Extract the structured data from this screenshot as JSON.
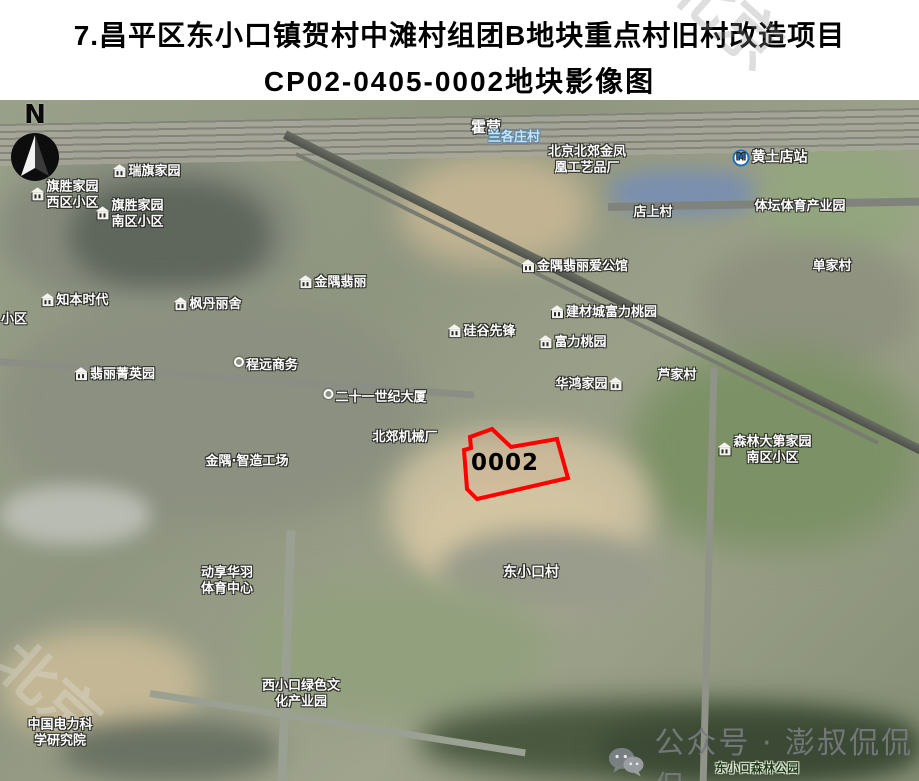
{
  "title": {
    "line1": "7.昌平区东小口镇贺村中滩村组团B地块重点村旧村改造项目",
    "line2": "CP02-0405-0002地块影像图"
  },
  "faint_watermark": "北京",
  "map": {
    "compass_letter": "N",
    "parcel": {
      "id": "0002",
      "outline_color": "#ff0000",
      "points": "492,329 511,347 557,339 568,378 477,399 467,389 464,350 471,348 470,337",
      "label_x": 505,
      "label_y": 363
    },
    "wechat_watermark": "公众号 · 澎叔侃侃侃",
    "labels": [
      {
        "text": "霍营",
        "x": 486,
        "y": 27,
        "style": "white",
        "size": 15
      },
      {
        "text": "黄土店站",
        "x": 770,
        "y": 58,
        "style": "white",
        "size": 14,
        "icon": "metro"
      },
      {
        "text": "瑞旗家园",
        "x": 147,
        "y": 72,
        "style": "white",
        "icon": "building"
      },
      {
        "text": "旗胜家园",
        "text2": "西区小区",
        "x": 65,
        "y": 95,
        "style": "white",
        "icon": "building"
      },
      {
        "text": "旗胜家园",
        "text2": "南区小区",
        "x": 130,
        "y": 114,
        "style": "white",
        "icon": "building"
      },
      {
        "text": "兰各庄村",
        "x": 514,
        "y": 38,
        "style": "blue"
      },
      {
        "text": "北京北郊金凤",
        "text2": "凰工艺品厂",
        "x": 587,
        "y": 60,
        "style": "white"
      },
      {
        "text": "店上村",
        "x": 653,
        "y": 113,
        "style": "white"
      },
      {
        "text": "体坛体育产业园",
        "x": 800,
        "y": 107,
        "style": "white"
      },
      {
        "text": "单家村",
        "x": 832,
        "y": 167,
        "style": "white"
      },
      {
        "text": "知本时代",
        "x": 75,
        "y": 201,
        "style": "white",
        "icon": "building"
      },
      {
        "text": "枫丹丽舍",
        "x": 208,
        "y": 205,
        "style": "white",
        "icon": "building"
      },
      {
        "text": "小区",
        "x": 14,
        "y": 220,
        "style": "white"
      },
      {
        "text": "翡丽菁英园",
        "x": 115,
        "y": 275,
        "style": "white",
        "icon": "building"
      },
      {
        "text": "程远商务",
        "x": 266,
        "y": 266,
        "style": "white",
        "icon": "dot"
      },
      {
        "text": "金隅翡丽",
        "x": 333,
        "y": 183,
        "style": "white",
        "icon": "building"
      },
      {
        "text": "金隅翡丽爱公馆",
        "x": 575,
        "y": 167,
        "style": "white",
        "icon": "building"
      },
      {
        "text": "硅谷先锋",
        "x": 482,
        "y": 232,
        "style": "white",
        "icon": "building"
      },
      {
        "text": "建材城富力桃园",
        "x": 604,
        "y": 213,
        "style": "white",
        "icon": "building"
      },
      {
        "text": "富力桃园",
        "x": 573,
        "y": 243,
        "style": "white",
        "icon": "building"
      },
      {
        "text": "华鸿家园",
        "x": 589,
        "y": 285,
        "style": "white",
        "icon": "building",
        "icon_side": "right"
      },
      {
        "text": "芦家村",
        "x": 677,
        "y": 276,
        "style": "white"
      },
      {
        "text": "二十一世纪大厦",
        "x": 375,
        "y": 298,
        "style": "white",
        "icon": "dot"
      },
      {
        "text": "北郊机械厂",
        "x": 405,
        "y": 338,
        "style": "white"
      },
      {
        "text": "金隅·智造工场",
        "x": 247,
        "y": 362,
        "style": "white"
      },
      {
        "text": "森林大第家园",
        "text2": "南区小区",
        "x": 765,
        "y": 350,
        "style": "white",
        "icon": "building"
      },
      {
        "text": "东小口村",
        "x": 531,
        "y": 473,
        "style": "white",
        "size": 14
      },
      {
        "text": "动享华羽",
        "text2": "体育中心",
        "x": 227,
        "y": 481,
        "style": "white"
      },
      {
        "text": "西小口绿色文",
        "text2": "化产业园",
        "x": 301,
        "y": 594,
        "style": "white"
      },
      {
        "text": "中国电力科",
        "text2": "学研究院",
        "x": 60,
        "y": 633,
        "style": "white"
      },
      {
        "text": "东小口森林公园",
        "x": 757,
        "y": 668,
        "style": "dark",
        "size": 12
      }
    ]
  }
}
